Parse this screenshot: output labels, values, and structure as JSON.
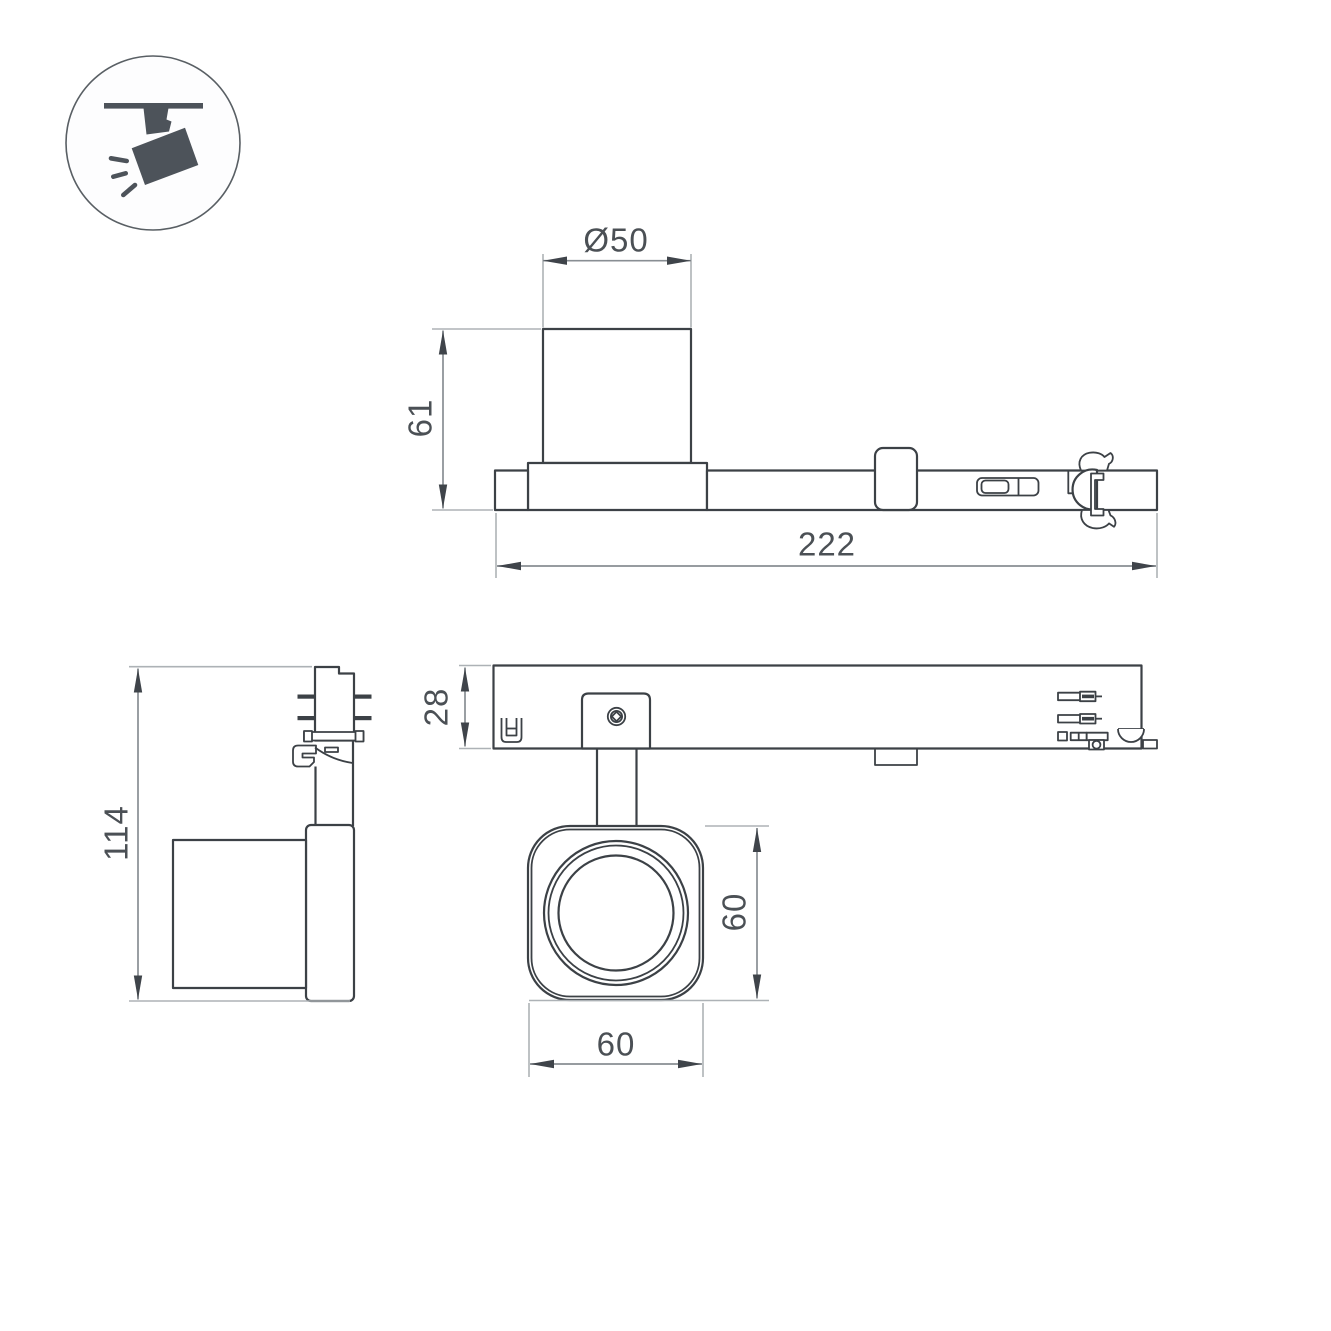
{
  "legend": {
    "icon": "track-spotlight-icon"
  },
  "colors": {
    "background": "#ffffff",
    "part_line": "#3c4146",
    "dimension_line": "#888e93",
    "extension_line": "#adb2b6",
    "arrow": "#3f444a",
    "label_text": "#4b5055",
    "icon_fill": "#4d535a",
    "icon_ring": "#595f64"
  },
  "views": {
    "side": {
      "dimensions": {
        "lamp_diameter": "Ø50",
        "lamp_height": "61",
        "track_length": "222"
      }
    },
    "front": {
      "dimensions": {
        "total_height": "114"
      }
    },
    "top": {
      "dimensions": {
        "base_depth": "28",
        "head_height": "60",
        "head_width": "60"
      }
    }
  }
}
